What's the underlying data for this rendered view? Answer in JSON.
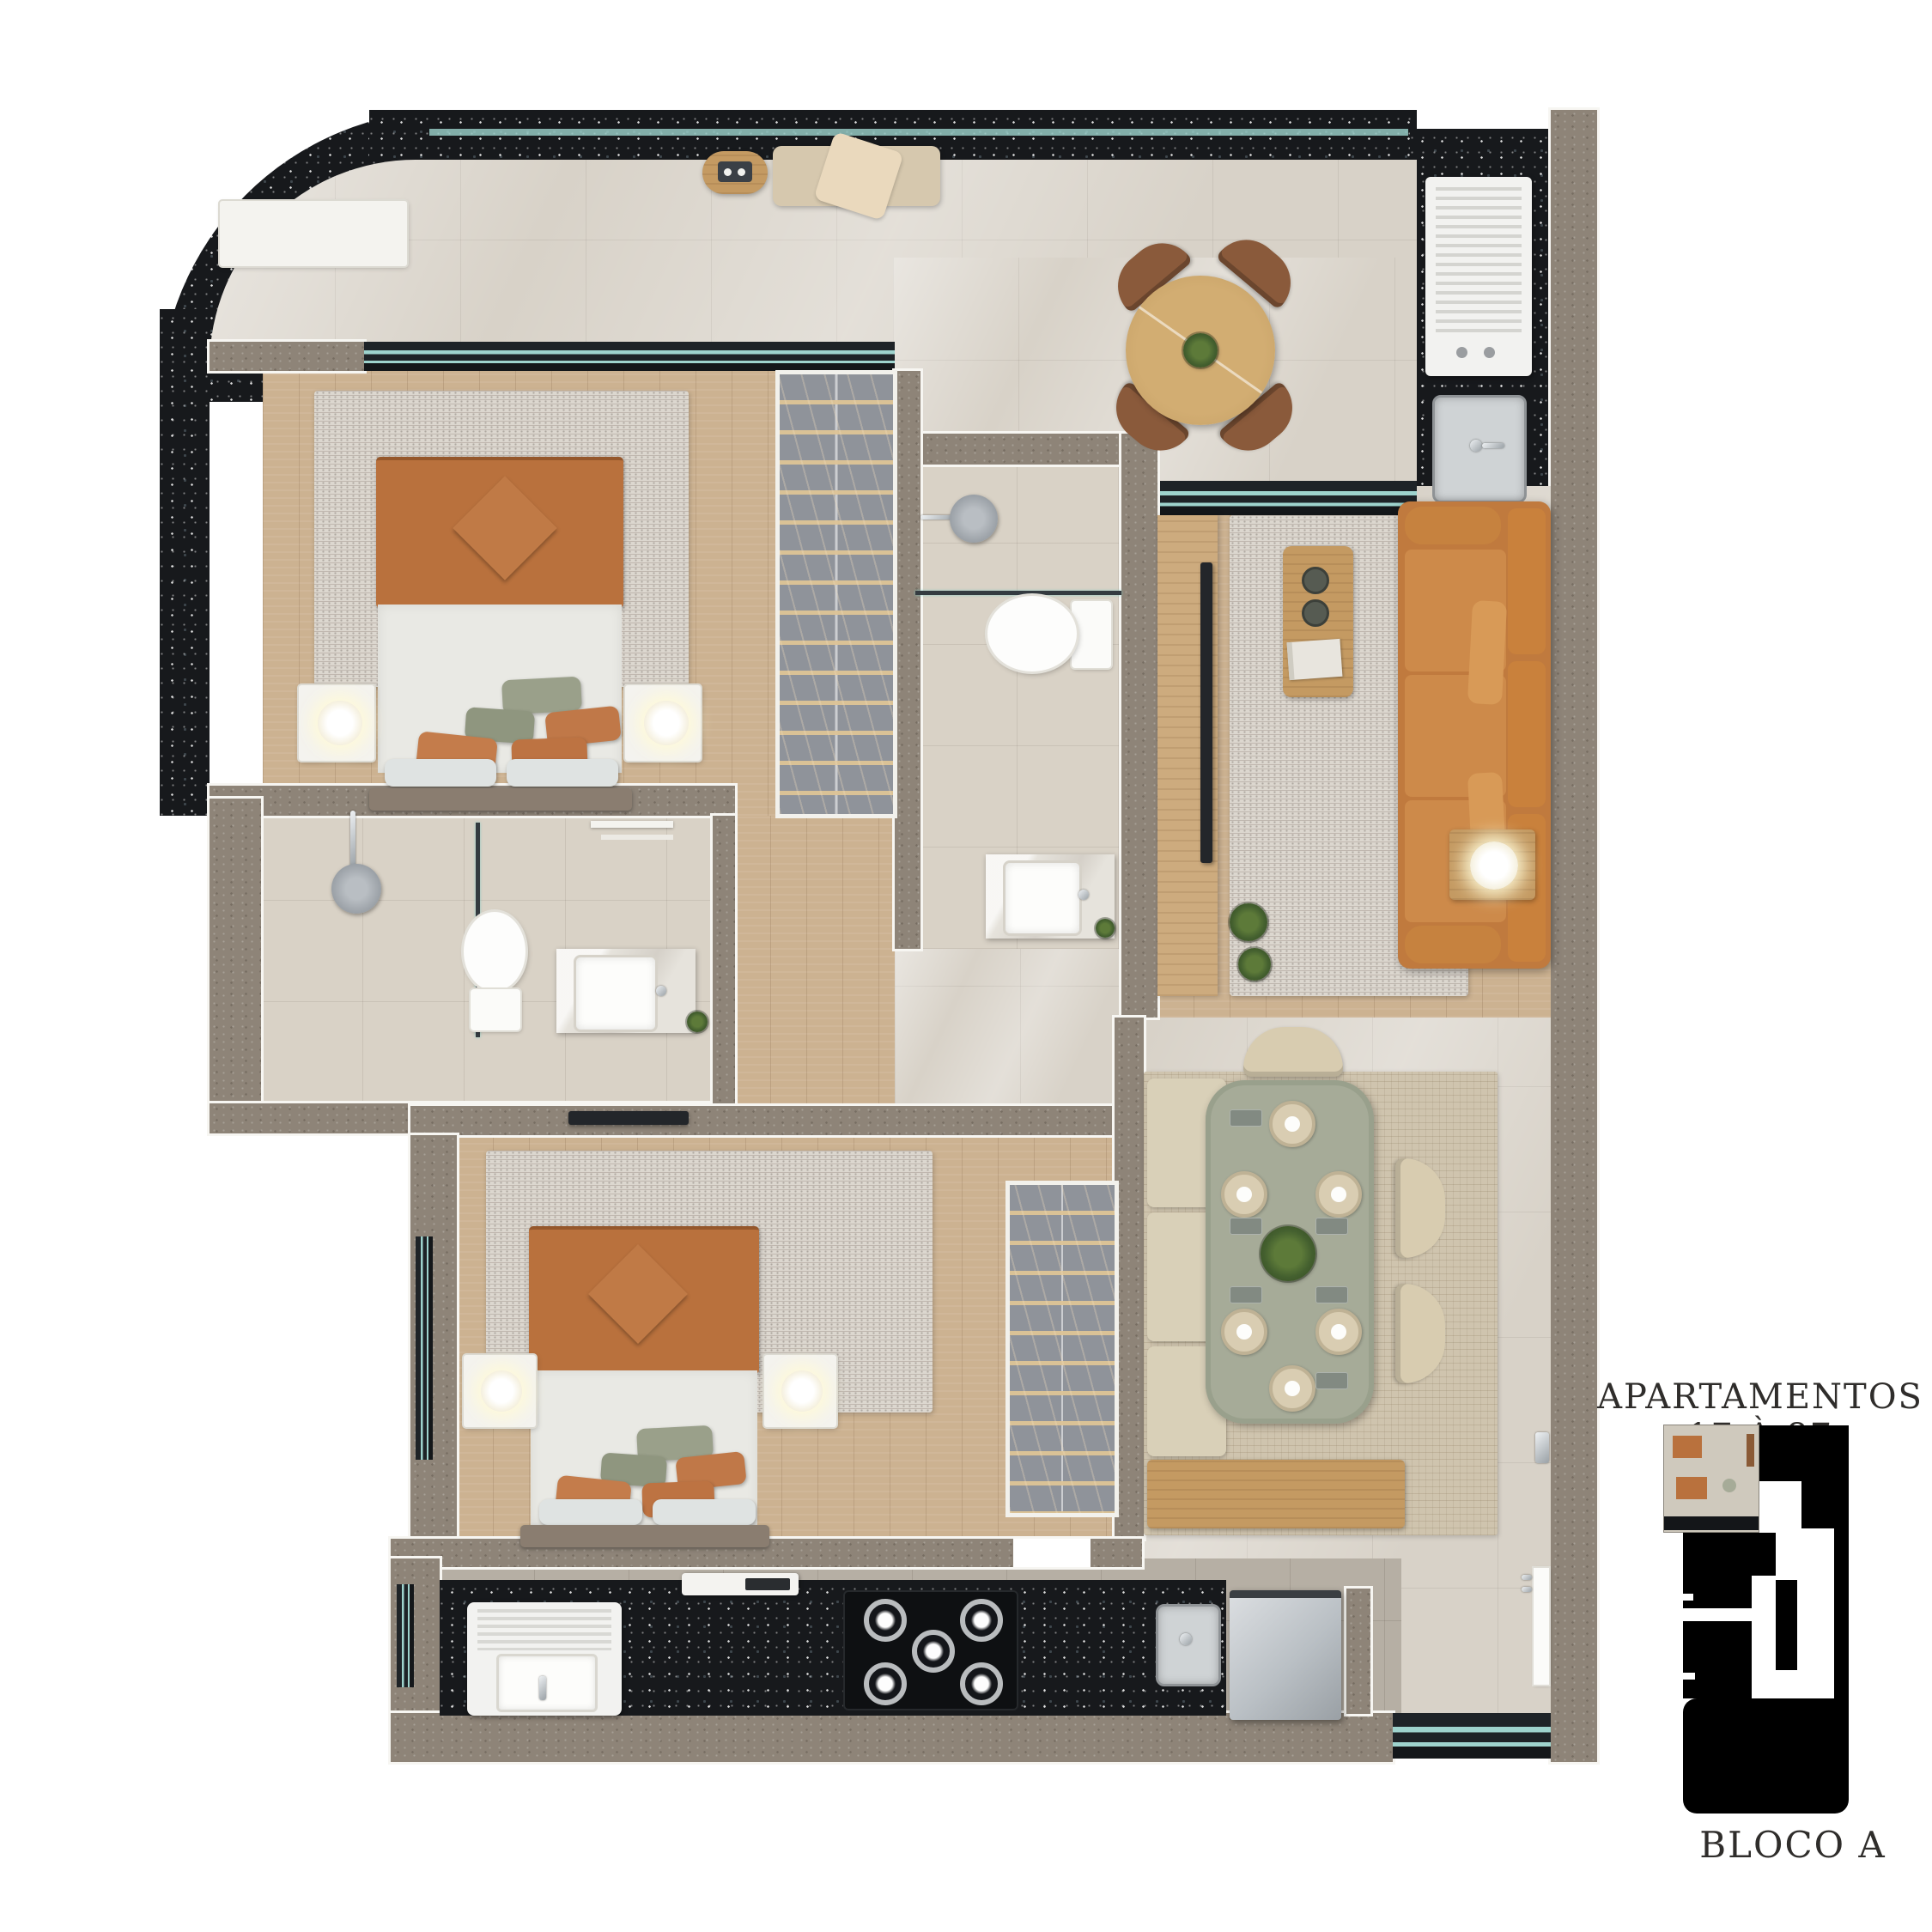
{
  "legend": {
    "apartments_label": "APARTAMENTOS 17 À 87",
    "block_label": "BLOCO A"
  },
  "palette": {
    "background": "#ffffff",
    "wall-dark": "#17191c",
    "wall-gray": "#8e8478",
    "floor-marble": "#d8d2c8",
    "floor-wood": "#ccb291",
    "floor-tile-beige": "#d9d2c6",
    "floor-tile-gray": "#b6afa4",
    "rug-light": "#dcd7cf",
    "rug-beige": "#cfc4ae",
    "accent-terracotta": "#b9713d",
    "accent-caramel": "#c07a3e",
    "accent-sage": "#a6ab98",
    "wood-furniture": "#c49a62",
    "counter-black": "#141619",
    "glass-teal": "#9ed3cd",
    "text-color": "#2f2d2b",
    "keymap-black": "#000000"
  }
}
